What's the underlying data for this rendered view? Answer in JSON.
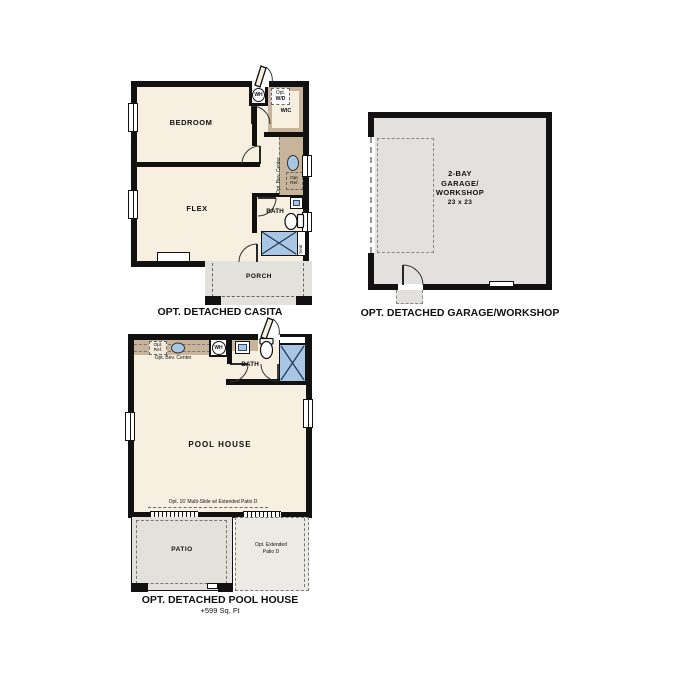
{
  "colors": {
    "wall": "#111111",
    "floor_cream": "#f7efe0",
    "garage_gray": "#e3e1de",
    "patio_gray": "#e3e1dc",
    "ext_patio_gray": "#eceae5",
    "counter_tan": "#c8b49a",
    "fixture_blue": "#a9c7e4",
    "dash_gray": "#777777"
  },
  "casita": {
    "title": "OPT. DETACHED CASITA",
    "bedroom": "BEDROOM",
    "flex": "FLEX",
    "wic": "WIC",
    "bath": "BATH",
    "porch": "PORCH",
    "wh": "WH",
    "opt_wd_line1": "Opt.",
    "opt_wd_line2": "W/D",
    "bev_center": "Opt. Bev. Center",
    "ref_line1": "Opt.",
    "ref_line2": "Ref.",
    "seat": "Seat"
  },
  "garage": {
    "title": "OPT. DETACHED GARAGE/WORKSHOP",
    "name_line1": "2-BAY",
    "name_line2": "GARAGE/",
    "name_line3": "WORKSHOP",
    "dimensions": "23 x 23"
  },
  "pool_house": {
    "title": "OPT. DETACHED POOL HOUSE",
    "area": "+599 Sq. Ft",
    "main_room": "POOL HOUSE",
    "bath": "BATH",
    "patio": "PATIO",
    "wh": "WH",
    "bev_center": "Opt. Bev. Center",
    "ref_line1": "Opt.",
    "ref_line2": "Ref.",
    "seat": "Seat",
    "multislide_note": "Opt. 16' Multi-Slide w/ Extended Patio D",
    "ext_patio_line1": "Opt. Extended",
    "ext_patio_line2": "Patio D"
  }
}
